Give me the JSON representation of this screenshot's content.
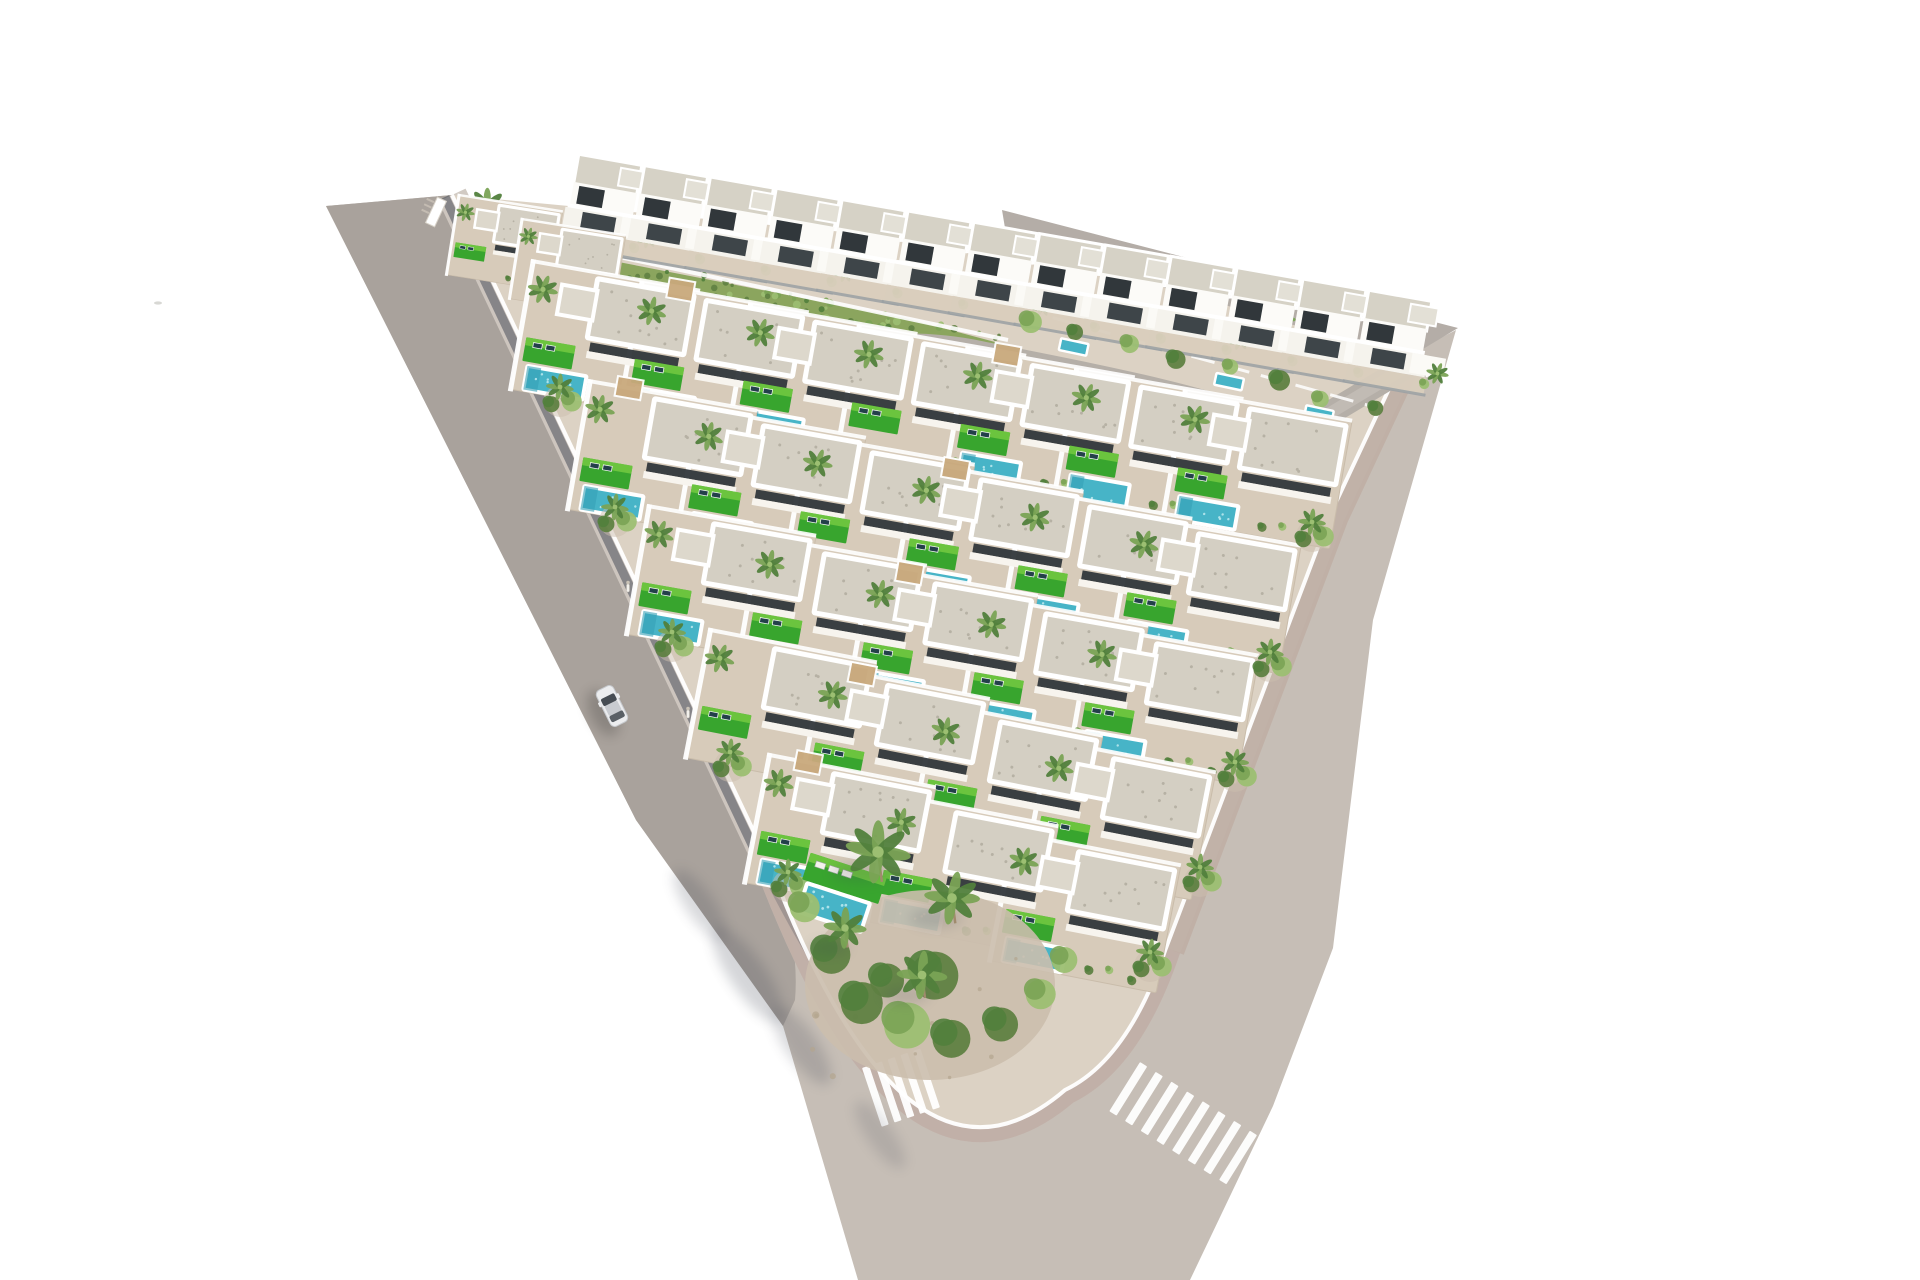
{
  "meta": {
    "scene": "aerial-render-triangular-villa-development",
    "canvas_width": 1920,
    "canvas_height": 1280,
    "background": "#ffffff",
    "seed": 7
  },
  "palette": {
    "road_main": "#c6beb6",
    "road_left": "#a9a29c",
    "road_top": "#b4ada7",
    "sidewalk": "#cfc7c0",
    "curb": "#beaca3",
    "shadow": "#3f4552",
    "plot": "#dcd2c4",
    "terrace": "#d7cbba",
    "terrace_line": "#c9bcaa",
    "roof": "#d4cfc3",
    "roof_dot": "#b6b1a4",
    "roof2": "#ddd8cc",
    "glass": "#31373b",
    "white": "#ffffff",
    "pool": "#47b4c7",
    "pool_dark": "#35a0b5",
    "pool_light": "#bfeaf0",
    "lawn": "#38a52e",
    "lawn_light": "#78cc42",
    "palm": "#7aa355",
    "palm_dark": "#51803c",
    "palm_light": "#9cbf72",
    "shrub_olive": "#5f8142",
    "gravel": "#cbbead",
    "trunk": "#a08b6d",
    "fence": "#9aa0a3",
    "pergola": "#c9a97c",
    "hillside": "#8ba55e",
    "car_body": "#ecedef",
    "car_glass": "#474d54",
    "car_roof": "#c8cbd0"
  },
  "layers": {
    "road_main_path": "M 326,206 L 452,195 L 772,870 Q 908,1225 1065,1090 Q 1128,1060 1166,948 L 1330,515 L 1404,357 L 1456,330 L 1373,620 L 1333,948 L 1273,1106 L 1190,1280 L 858,1280 L 783,1026 L 636,820 Z",
    "road_left_path": "M 326,206 L 452,195 L 772,870 Q 800,940 795,1000 L 783,1026 L 636,820 Z",
    "road_top_path": "M 1002,210 L 1458,328 L 1408,358 L 1008,246 Z",
    "plot_path": "M 452,195 L 772,870 Q 908,1225 1065,1090 Q 1128,1060 1166,948 L 1330,515 L 1404,357 L 1035,250 Z",
    "plot_edge_path": "M 452,195 L 772,870 Q 908,1225 1065,1090 Q 1128,1060 1166,948 L 1330,515 L 1404,357",
    "right_curb_path": "M 1404,357 L 1330,515 L 1166,948",
    "wall_shadow_path": "M 445,197 L 765,872",
    "wall_shadow2_path": "M 765,872 Q 850,1040 905,1068",
    "hillside_path": "M 598,258 L 905,318 L 1010,346 L 995,372 L 880,340 L 610,290 Z",
    "hill_wall": {
      "x1": 596,
      "y1": 252,
      "x2": 1008,
      "y2": 340
    },
    "internal_road_path": "M 630,345 C 780,366 880,332 980,354 C 1100,378 1200,396 1290,432",
    "entrance_road_path": "M 1415,362 L 1295,434",
    "garden_wall_dash": {
      "x1": 1018,
      "y1": 308,
      "x2": 1378,
      "y2": 408
    }
  },
  "crosswalks": [
    {
      "x": 862,
      "y": 1068,
      "rot": -18.5,
      "count": 5,
      "step": 13.5,
      "w": 7.5,
      "len": 62
    },
    {
      "x": 1140,
      "y": 1062,
      "rot": 32,
      "count": 8,
      "step": 18.5,
      "w": 8.5,
      "len": 58
    },
    {
      "x": 1422,
      "y": 352,
      "rot": 55,
      "count": 4,
      "step": 7,
      "w": 2.6,
      "len": 11
    }
  ],
  "rows": [
    {
      "x1": 606,
      "y1": 335,
      "x2": 1258,
      "y2": 465,
      "count": 7,
      "rot": 10
    },
    {
      "x1": 663,
      "y1": 455,
      "x2": 1207,
      "y2": 590,
      "count": 6,
      "rot": 10
    },
    {
      "x1": 722,
      "y1": 580,
      "x2": 1165,
      "y2": 700,
      "count": 5,
      "rot": 10
    },
    {
      "x1": 782,
      "y1": 705,
      "x2": 1121,
      "y2": 815,
      "count": 4,
      "rot": 11
    },
    {
      "x1": 841,
      "y1": 830,
      "x2": 1086,
      "y2": 908,
      "count": 3,
      "rot": 11
    }
  ],
  "tip_villas": [
    {
      "x": 505,
      "y": 240,
      "rot": 9,
      "s": 0.62,
      "pool": false,
      "lawn": true
    },
    {
      "x": 568,
      "y": 264,
      "rot": 9,
      "s": 0.62,
      "pool": false,
      "lawn": false
    }
  ],
  "top_houses": {
    "x1": 608,
    "y1": 196,
    "x2": 1398,
    "y2": 332,
    "count": 13,
    "rot": 10
  },
  "skyline_palms": [
    [
      487,
      206,
      15
    ],
    [
      585,
      208,
      12
    ],
    [
      725,
      228,
      12
    ],
    [
      860,
      250,
      13
    ],
    [
      1000,
      272,
      12
    ],
    [
      1140,
      295,
      12
    ],
    [
      1282,
      318,
      11
    ]
  ],
  "behind_row_shrubs": {
    "x1": 1030,
    "y1": 316,
    "x2": 1370,
    "y2": 410,
    "count": 8
  },
  "edge_clusters_left": [
    [
      560,
      395
    ],
    [
      615,
      515
    ],
    [
      672,
      640
    ],
    [
      730,
      760
    ],
    [
      788,
      880
    ]
  ],
  "edge_clusters_right": [
    [
      1312,
      530
    ],
    [
      1270,
      660
    ],
    [
      1235,
      770
    ],
    [
      1200,
      875
    ],
    [
      1150,
      960
    ]
  ],
  "corner_garden": {
    "ground": {
      "cx": 930,
      "cy": 985,
      "rx": 125,
      "ry": 95
    },
    "pool_group": {
      "x": 842,
      "y": 886,
      "rot": 18
    },
    "palms": [
      [
        878,
        852,
        26
      ],
      [
        952,
        898,
        22
      ],
      [
        845,
        928,
        17
      ],
      [
        922,
        975,
        20
      ]
    ],
    "shrubs": [
      [
        802,
        905,
        15
      ],
      [
        828,
        952,
        19
      ],
      [
        858,
        1000,
        21
      ],
      [
        903,
        1022,
        23
      ],
      [
        948,
        1036,
        19
      ],
      [
        998,
        1022,
        17
      ],
      [
        1038,
        992,
        15
      ],
      [
        930,
        972,
        24
      ],
      [
        884,
        978,
        17
      ],
      [
        1062,
        958,
        13
      ]
    ]
  },
  "car": {
    "x": 612,
    "y": 706,
    "rot": -26.6
  },
  "people": [
    [
      628,
      588
    ],
    [
      688,
      714
    ]
  ],
  "bird_speck": {
    "x": 158,
    "y": 303
  },
  "gate": {
    "x": 436,
    "y": 212,
    "rot": 25
  },
  "shadows": {
    "palm_blobs": [
      {
        "cx": 700,
        "cy": 905,
        "rx": 42,
        "ry": 14,
        "rot": 55,
        "o": 0.2
      },
      {
        "cx": 748,
        "cy": 975,
        "rx": 56,
        "ry": 18,
        "rot": 55,
        "o": 0.22
      },
      {
        "cx": 802,
        "cy": 1046,
        "rx": 46,
        "ry": 16,
        "rot": 55,
        "o": 0.2
      },
      {
        "cx": 880,
        "cy": 1135,
        "rx": 40,
        "ry": 13,
        "rot": 55,
        "o": 0.15
      }
    ],
    "car_shadow": {
      "cx": 603,
      "cy": 713,
      "rx": 13,
      "ry": 25,
      "rot": -26.6,
      "o": 0.18
    }
  }
}
